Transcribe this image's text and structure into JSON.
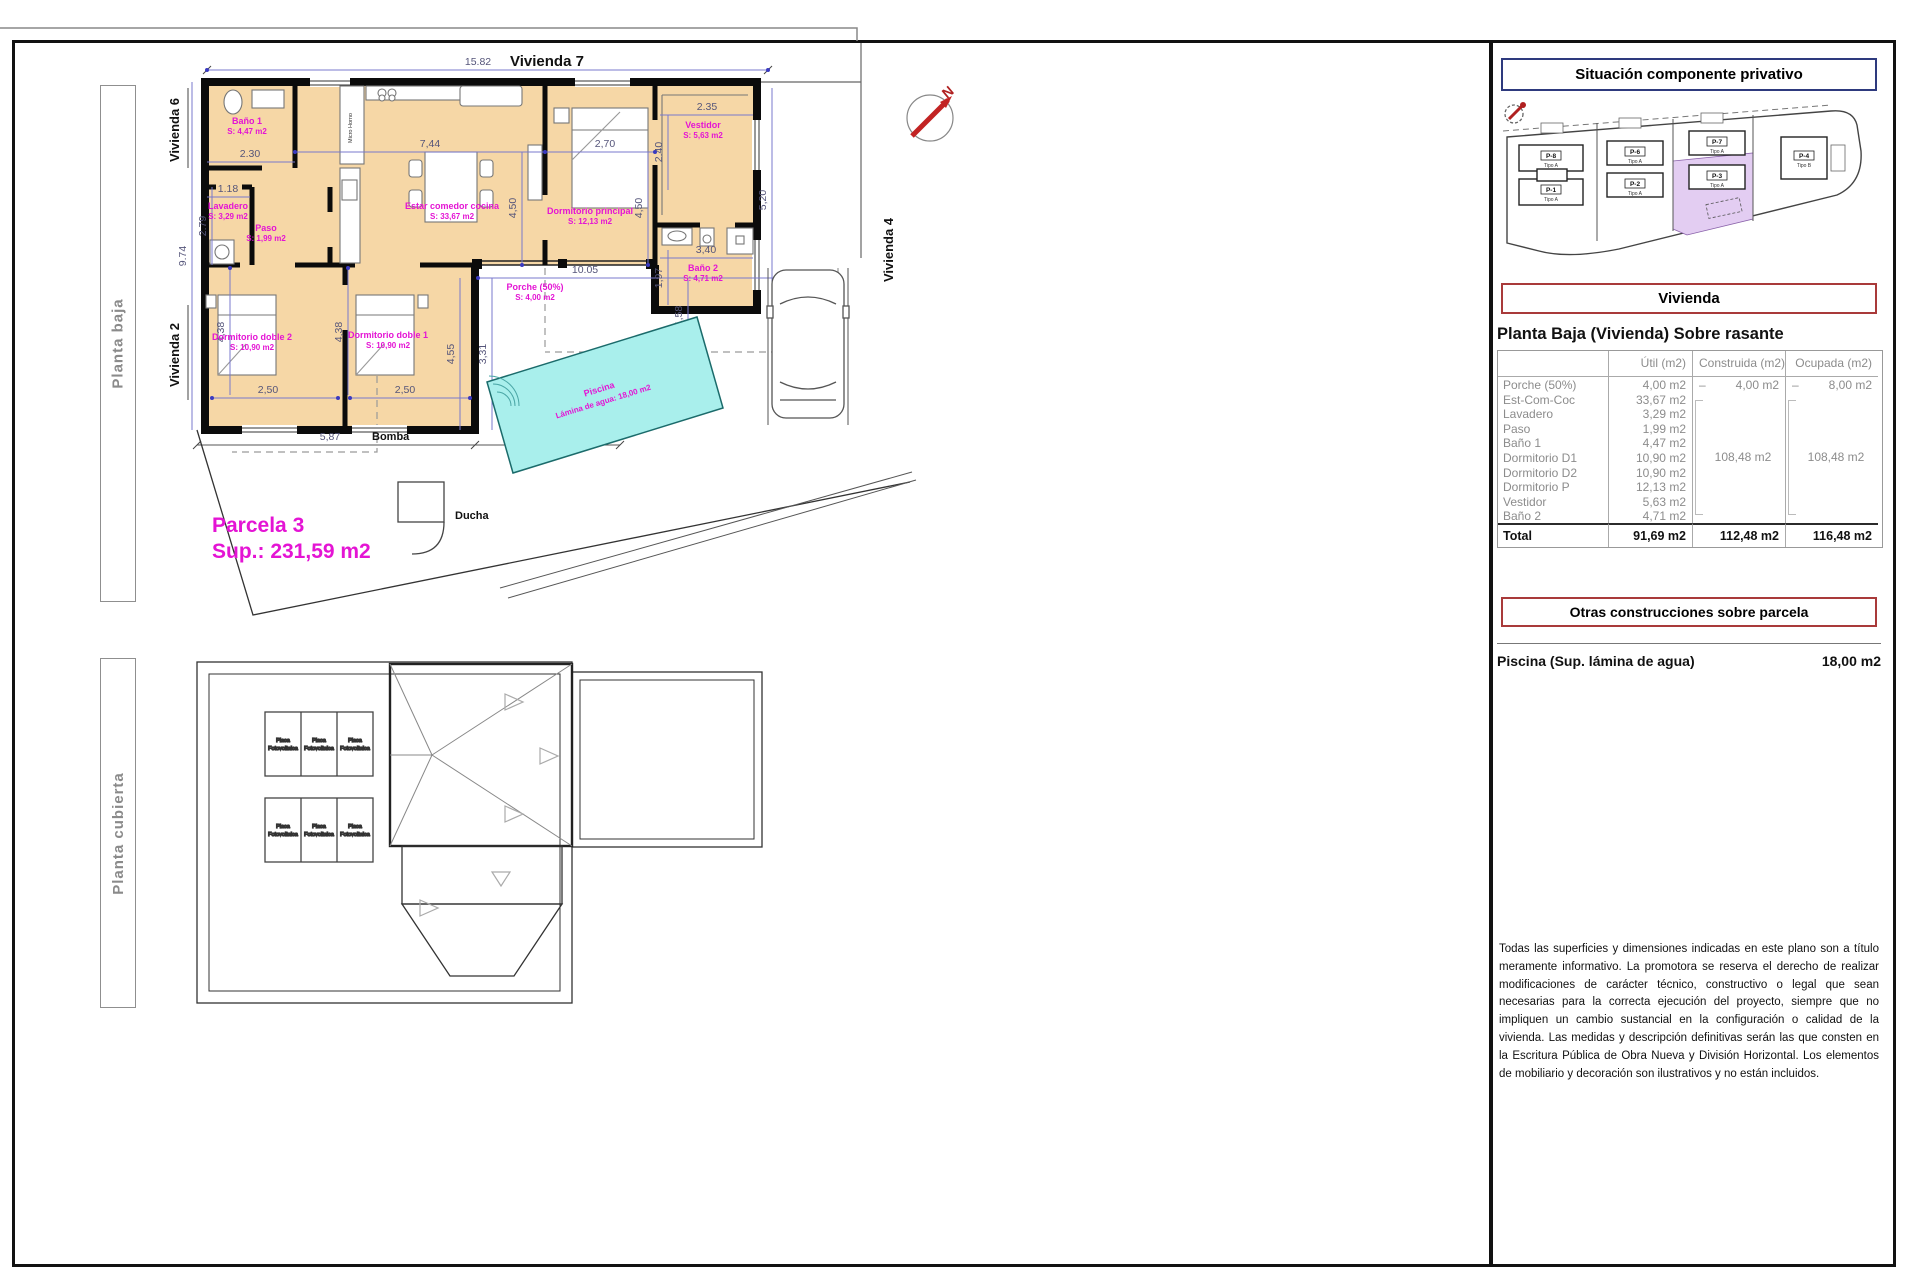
{
  "sheet": {
    "top_dim": "15.82",
    "top_title": "Vivienda 7",
    "label_vivienda6": "Vivienda 6",
    "label_vivienda2": "Vivienda 2",
    "label_vivienda4": "Vivienda 4",
    "side_planta_baja": "Planta baja",
    "side_planta_cubierta": "Planta cubierta",
    "north_letter": "N"
  },
  "floorplan": {
    "rooms": {
      "bano1": {
        "name": "Baño 1",
        "area": "S: 4,47 m2"
      },
      "lavadero": {
        "name": "Lavadero",
        "area": "S: 3,29 m2"
      },
      "paso": {
        "name": "Paso",
        "area": "S: 1,99 m2"
      },
      "estar": {
        "name": "Estar comedor cocina",
        "area": "S: 33,67 m2"
      },
      "dormitorio_principal": {
        "name": "Dormitorio principal",
        "area": "S: 12,13 m2"
      },
      "vestidor": {
        "name": "Vestidor",
        "area": "S: 5,63 m2"
      },
      "bano2": {
        "name": "Baño 2",
        "area": "S: 4,71 m2"
      },
      "dormitorio_doble2": {
        "name": "Dormitorio doble 2",
        "area": "S: 10,90 m2"
      },
      "dormitorio_doble1": {
        "name": "Dormitorio doble 1",
        "area": "S: 10,90 m2"
      },
      "porche": {
        "name": "Porche (50%)",
        "area": "S: 4,00 m2"
      }
    },
    "dims": {
      "total_width": "15.82",
      "bano1_w": "2.30",
      "lavadero_w": "1.18",
      "lavadero_h": "2.79",
      "left_h": "9.74",
      "estar_w": "7,44",
      "estar_h": "4,50",
      "dorm_w": "2,70",
      "dorm_h": "4,50",
      "vestidor_w": "2.35",
      "vestidor_h": "2.40",
      "bano2_w": "3,40",
      "bano2_h": "1,97",
      "annex_h": "5,20",
      "porche_w": "10.05",
      "porche_h": "1,58",
      "patio_h1": "3,31",
      "patio_h2": "4,55",
      "dd2_h": "4,38",
      "dd1_h": "4,38",
      "dd2_w": "2,50",
      "dd1_w": "2,50",
      "wing_w": "5,87"
    },
    "annotations": {
      "bomba": "Bomba",
      "ducha": "Ducha",
      "micro_horno": "Micro Horno"
    },
    "pool": {
      "name": "Piscina",
      "detail": "Lámina de agua: 18,00 m2"
    },
    "parcel": {
      "title": "Parcela 3",
      "area": "Sup.: 231,59 m2"
    }
  },
  "roofplan": {
    "panel_line1": "Placa",
    "panel_line2": "Fotovoltaica"
  },
  "sidebar": {
    "situacion_title": "Situación componente privativo",
    "parcels": {
      "p8": {
        "id": "P-8",
        "tipo": "Tipo A"
      },
      "p1": {
        "id": "P-1",
        "tipo": "Tipo A"
      },
      "p6": {
        "id": "P-6",
        "tipo": "Tipo A"
      },
      "p2": {
        "id": "P-2",
        "tipo": "Tipo A"
      },
      "p7": {
        "id": "P-7",
        "tipo": "Tipo A"
      },
      "p3": {
        "id": "P-3",
        "tipo": "Tipo A"
      },
      "p4": {
        "id": "P-4",
        "tipo": "Tipo B"
      }
    },
    "vivienda_title": "Vivienda",
    "table": {
      "heading": "Planta Baja (Vivienda) Sobre rasante",
      "col_util": "Útil (m2)",
      "col_construida": "Construida (m2)",
      "col_ocupada": "Ocupada (m2)",
      "rows": [
        {
          "label": "Porche (50%)",
          "util": "4,00 m2",
          "dash": "–",
          "construida": "4,00 m2",
          "ocupada": "8,00 m2"
        },
        {
          "label": "Est-Com-Coc",
          "util": "33,67 m2"
        },
        {
          "label": "Lavadero",
          "util": "3,29 m2"
        },
        {
          "label": "Paso",
          "util": "1,99 m2"
        },
        {
          "label": "Baño 1",
          "util": "4,47 m2"
        },
        {
          "label": "Dormitorio D1",
          "util": "10,90 m2"
        },
        {
          "label": "Dormitorio D2",
          "util": "10,90 m2"
        },
        {
          "label": "Dormitorio P",
          "util": "12,13 m2"
        },
        {
          "label": "Vestidor",
          "util": "5,63 m2"
        },
        {
          "label": "Baño 2",
          "util": "4,71 m2"
        }
      ],
      "construida_group": "108,48 m2",
      "ocupada_group": "108,48 m2",
      "total": {
        "label": "Total",
        "util": "91,69 m2",
        "construida": "112,48 m2",
        "ocupada": "116,48 m2"
      }
    },
    "otras_title": "Otras construcciones sobre parcela",
    "piscina_label": "Piscina (Sup. lámina de agua)",
    "piscina_value": "18,00 m2",
    "disclaimer": "Todas las superficies y dimensiones indicadas en este plano son a título meramente informativo. La promotora se reserva el derecho de realizar modificaciones de carácter técnico, constructivo o legal que sean necesarias para la correcta ejecución del proyecto, siempre que no impliquen un cambio sustancial en la configuración o calidad de la vivienda. Las medidas y descripción definitivas serán las que consten en la Escritura Pública de Obra Nueva y División Horizontal. Los elementos de mobiliario y decoración son ilustrativos y no están incluidos."
  }
}
